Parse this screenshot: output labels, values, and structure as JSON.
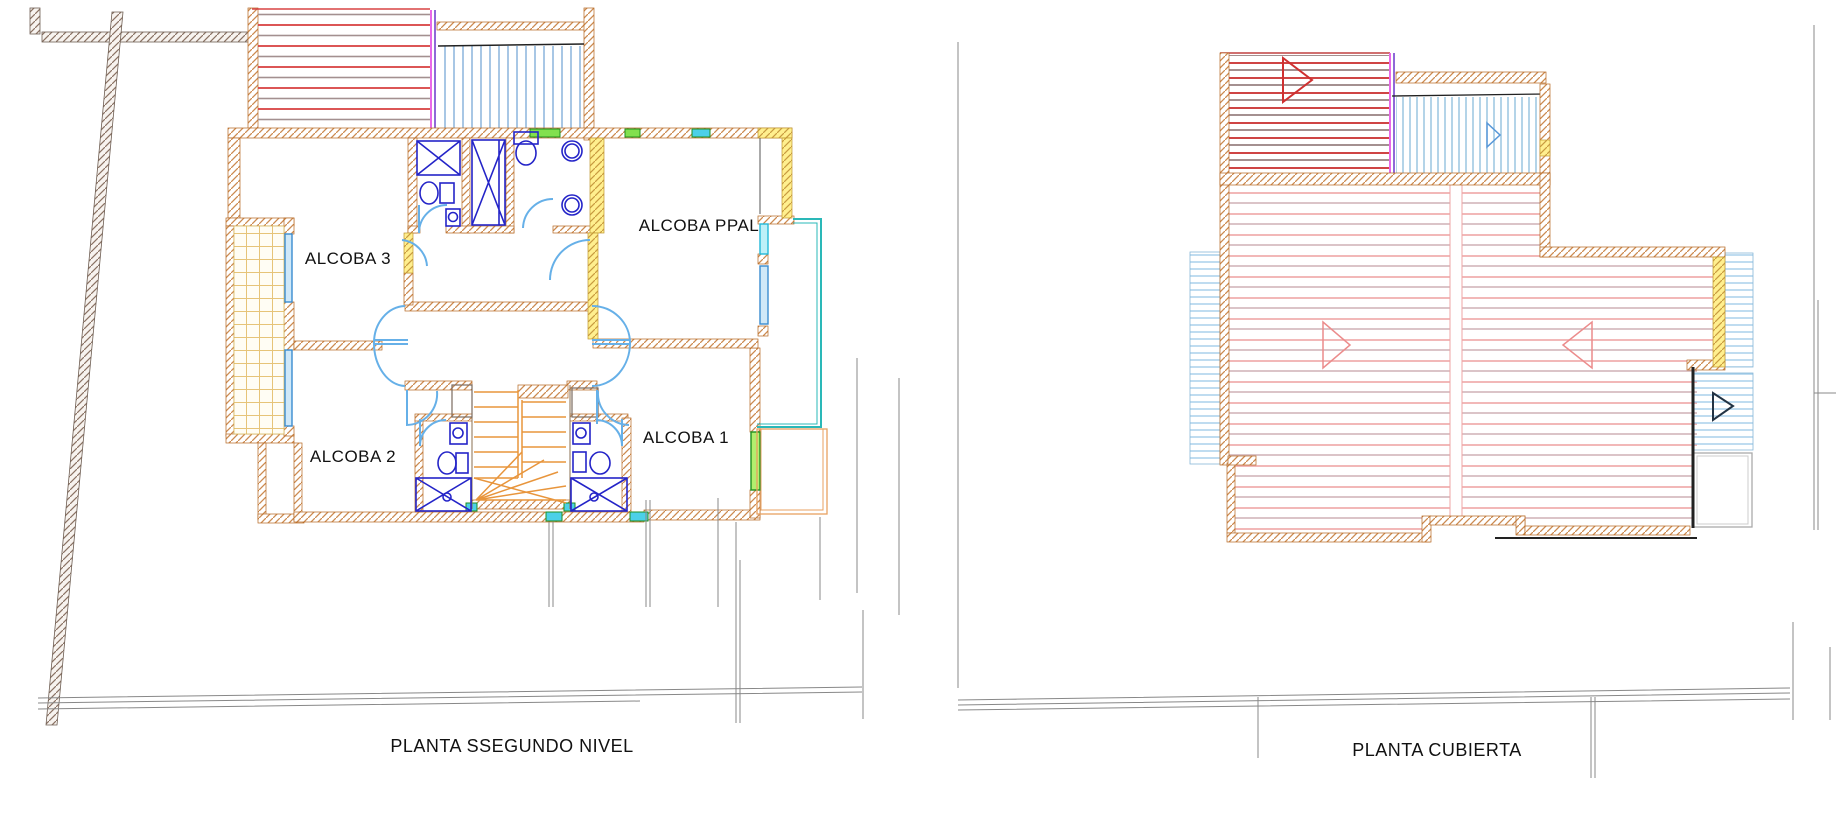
{
  "drawing": {
    "left_plan": {
      "title": "PLANTA SSEGUNDO NIVEL",
      "rooms": [
        {
          "label": "ALCOBA 3"
        },
        {
          "label": "ALCOBA PPAL"
        },
        {
          "label": "ALCOBA 2"
        },
        {
          "label": "ALCOBA 1"
        }
      ]
    },
    "right_plan": {
      "title": "PLANTA CUBIERTA"
    }
  },
  "colors": {
    "wall_hatch_orange": "#cc8a50",
    "wall_highlight_yellow": "#ffef8e",
    "boundary_hatch_gray": "#8a7263",
    "deck_red": "#d84343",
    "deck_blue": "#8ab4dc",
    "roof_pink": "#efa6a6",
    "roof_dark_red": "#cf4545",
    "roof_light_blue": "#9cc8e8",
    "magenta_strip": "#e868e8",
    "fixture_blue": "#2424c8",
    "door_arc_blue": "#66b0e8",
    "stair_orange": "#e8953c",
    "teal_rail": "#2ab8b8",
    "window_green": "#82e04e",
    "window_cyan": "#4cd0e8",
    "tile_yellow": "#e6c478",
    "site_line_gray": "#888888"
  }
}
